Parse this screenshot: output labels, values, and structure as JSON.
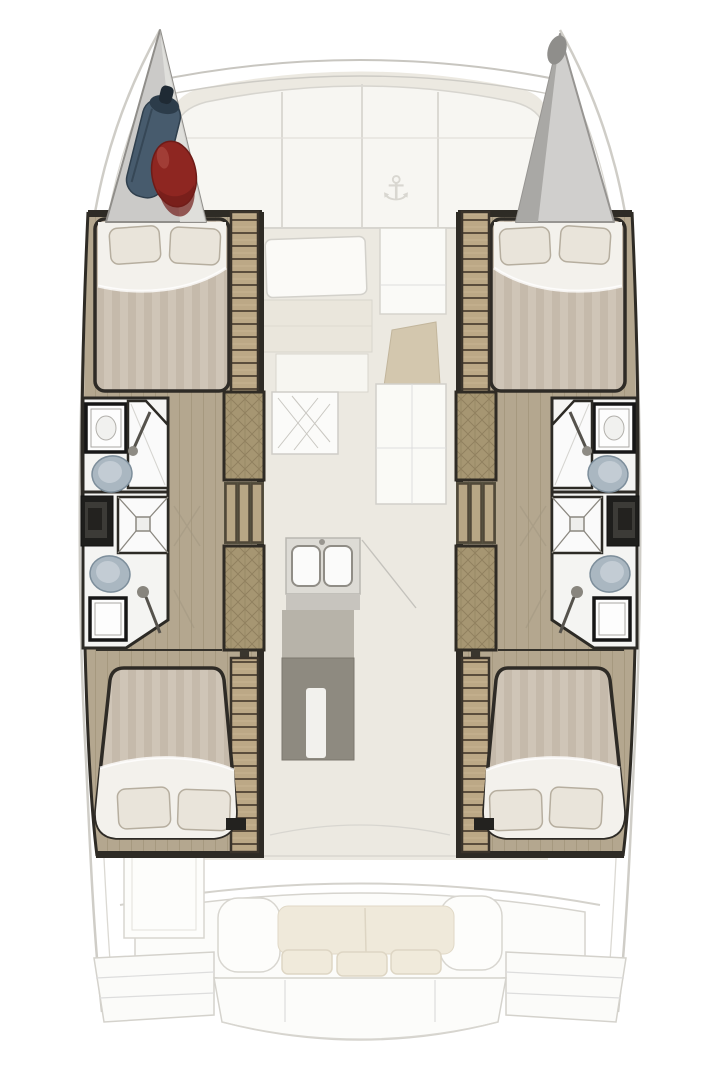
{
  "colors": {
    "background": "#ffffff",
    "ghost_line": "#cfcdc7",
    "ghost_line_soft": "#dbd9d3",
    "saloon_floor": "#ece9e1",
    "panel_white": "#f7f6f2",
    "hull_floor": "#b4a78f",
    "hull_floor_stripe": "#a6997f",
    "wood_panel": "#a69672",
    "wood_plank": "#bca886",
    "outline_dark": "#2e2b25",
    "duvet": "#cfc5b7",
    "duvet_stripe": "#c5baab",
    "bed_white": "#f3f1ec",
    "pillow": "#e9e4da",
    "pillow_edge": "#b6ae9f",
    "bathroom_white": "#f4f4f2",
    "shower_line": "#8b8880",
    "toilet_blue": "#aab7c1",
    "toilet_inner": "#c3ccd4",
    "vanity_black": "#1e1e1c",
    "sink_frame": "#161616",
    "island_gray": "#8e8a80",
    "island_light": "#b7b3a9",
    "counter_gray": "#dddbd5",
    "cushion_cream": "#efe9da",
    "cushion_edge": "#ded6c4",
    "bow_gray": "#cbcac8",
    "bow_gray_dark": "#a9a8a5",
    "fender_blue": "#475b6d",
    "fender_blue_dark": "#2c3c4a",
    "fender_red": "#8e2621",
    "fender_red_dark": "#701d19",
    "nav_tan": "#cbbc9e"
  },
  "icons": {
    "anchor_icon": "⚓"
  }
}
